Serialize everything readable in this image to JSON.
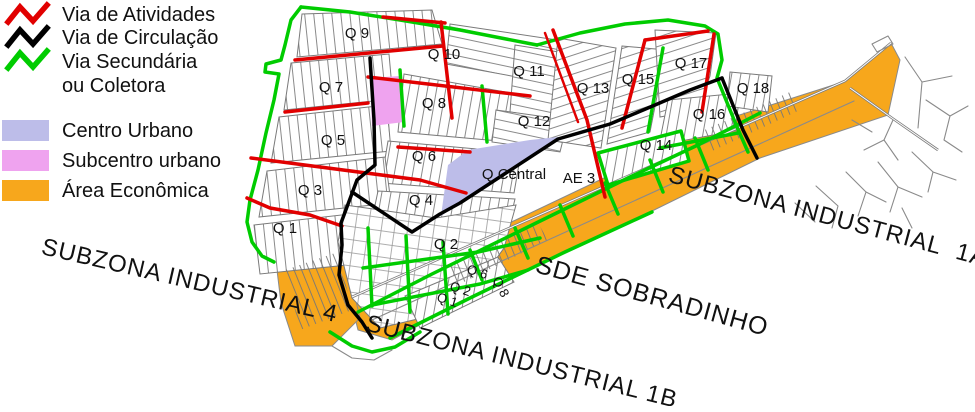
{
  "colors": {
    "activity_red": "#e10000",
    "circulation_black": "#000000",
    "secondary_green": "#00cc00",
    "centro_urbano": "#bdbde9",
    "subcentro": "#efa3ef",
    "area_economica": "#f7a71c"
  },
  "legend": {
    "road_items": [
      {
        "label": "Via de Atividades"
      },
      {
        "label": "Via de Circulação"
      },
      {
        "label": "Via Secundária",
        "label_line2": "ou Coletora"
      }
    ],
    "zone_items": [
      {
        "label": "Centro Urbano"
      },
      {
        "label": "Subcentro urbano"
      },
      {
        "label": "Área Econômica"
      }
    ]
  },
  "map": {
    "quadrants": {
      "q9": "Q 9",
      "q10": "Q 10",
      "q11": "Q 11",
      "q7": "Q 7",
      "q8": "Q 8",
      "q12": "Q 12",
      "q13": "Q 13",
      "q15": "Q 15",
      "q17": "Q 17",
      "q18": "Q 18",
      "q16": "Q 16",
      "q14": "Q 14",
      "q5": "Q 5",
      "q6": "Q 6",
      "q3": "Q 3",
      "q4": "Q 4",
      "q1": "Q 1",
      "q2": "Q 2",
      "q_central": "Q Central",
      "ae3": "AE 3",
      "q6_small": "Q 6",
      "q2_small": "Q 2",
      "q1_small": "Q 1",
      "q8_small": "Q 8"
    },
    "zones": {
      "subzona4": "SUBZONA INDUSTRIAL 4",
      "subzona1b": "SUBZONA INDUSTRIAL 1B",
      "sde": "SDE SOBRADINHO",
      "subzona1a": "SUBZONA INDUSTRIAL  1A"
    }
  }
}
